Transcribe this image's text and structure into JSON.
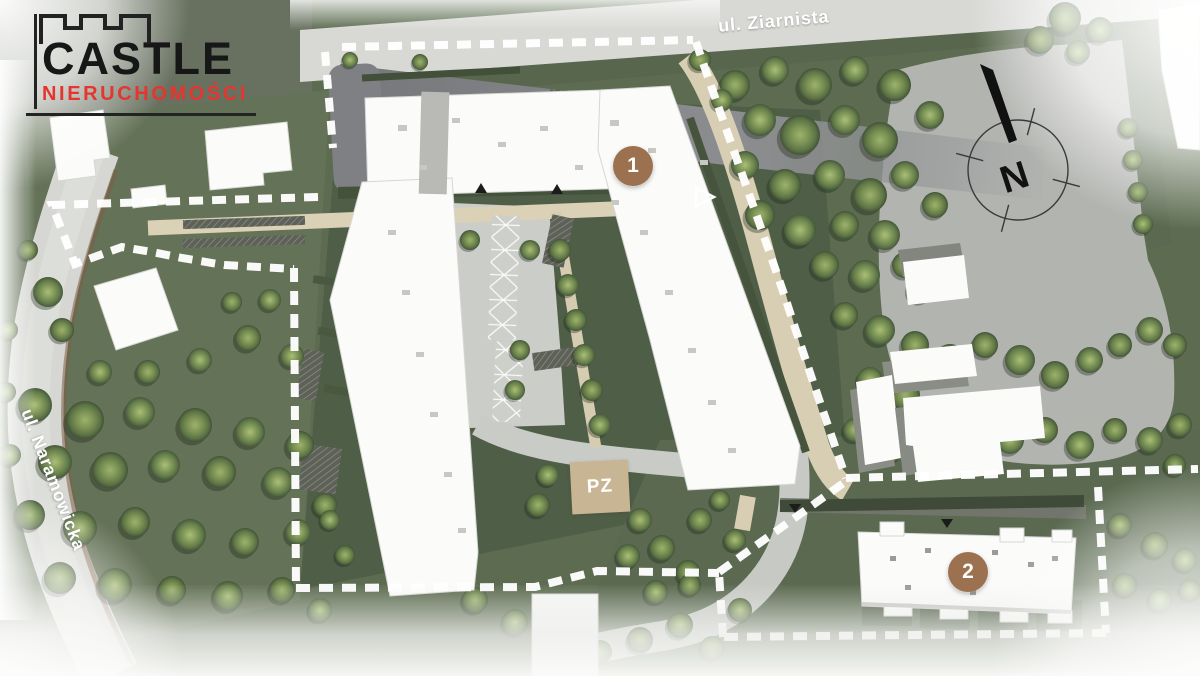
{
  "logo": {
    "name": "CASTLE",
    "subtitle": "NIERUCHOMOŚCI"
  },
  "map": {
    "streets": [
      {
        "id": "ziarnista",
        "label": "ul. Ziarnista"
      },
      {
        "id": "naramowicka",
        "label": "ul. Naramowicka"
      }
    ],
    "buildings": [
      {
        "id": "building-1",
        "label": "1"
      },
      {
        "id": "building-2",
        "label": "2"
      }
    ],
    "zones": [
      {
        "id": "pz",
        "label": "PZ"
      }
    ],
    "compass": {
      "label": "N"
    }
  },
  "colors": {
    "marker_brown": "#9b7150",
    "logo_red": "#e5352f",
    "logo_dark": "#1d1d1b",
    "pz_tan": "#c8b593",
    "boundary_dash": "#ffffff",
    "green_base": "#5d6c51",
    "road_light": "#d8d9d5",
    "road_dark": "#85868a"
  }
}
